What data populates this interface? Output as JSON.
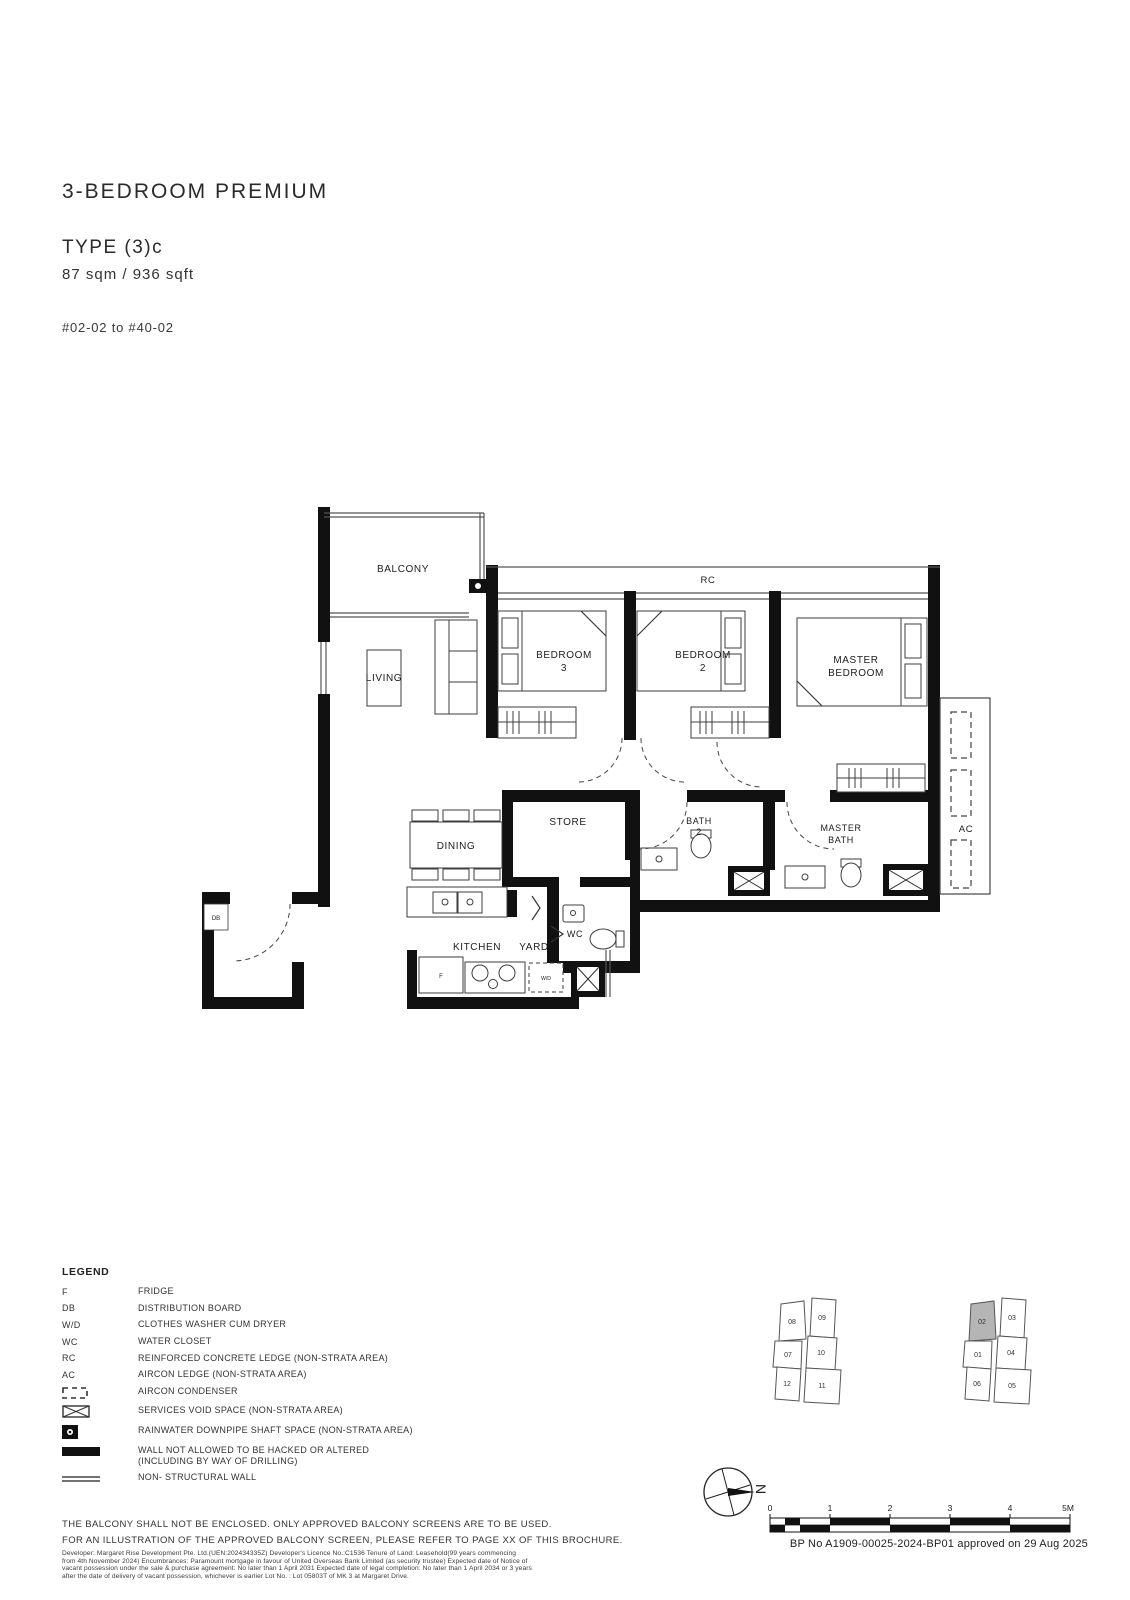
{
  "header": {
    "title": "3-BEDROOM PREMIUM",
    "type": "TYPE (3)c",
    "area": "87 sqm / 936 sqft",
    "units": "#02-02 to #40-02"
  },
  "plan": {
    "rooms": {
      "balcony": "BALCONY",
      "living": "LIVING",
      "bedroom3_1": "BEDROOM",
      "bedroom3_2": "3",
      "bedroom2_1": "BEDROOM",
      "bedroom2_2": "2",
      "master_1": "MASTER",
      "master_2": "BEDROOM",
      "rc": "RC",
      "ac": "AC",
      "dining": "DINING",
      "store": "STORE",
      "bath2_1": "BATH",
      "bath2_2": "2",
      "masterbath_1": "MASTER",
      "masterbath_2": "BATH",
      "wc": "WC",
      "kitchen": "KITCHEN",
      "yard": "YARD",
      "db": "DB",
      "fridge": "F",
      "washer": "W/D"
    }
  },
  "legend": {
    "heading": "LEGEND",
    "items": [
      {
        "symbol": "F",
        "label": "FRIDGE"
      },
      {
        "symbol": "DB",
        "label": "DISTRIBUTION BOARD"
      },
      {
        "symbol": "W/D",
        "label": "CLOTHES WASHER CUM DRYER"
      },
      {
        "symbol": "WC",
        "label": "WATER CLOSET"
      },
      {
        "symbol": "RC",
        "label": "REINFORCED CONCRETE LEDGE (NON-STRATA AREA)"
      },
      {
        "symbol": "AC",
        "label": "AIRCON LEDGE (NON-STRATA AREA)"
      },
      {
        "symbol": "",
        "label": "AIRCON CONDENSER"
      },
      {
        "symbol": "",
        "label": "SERVICES VOID SPACE (NON-STRATA AREA)"
      },
      {
        "symbol": "",
        "label": "RAINWATER DOWNPIPE SHAFT SPACE (NON-STRATA AREA)"
      },
      {
        "symbol": "",
        "label": "WALL NOT ALLOWED TO BE HACKED OR ALTERED",
        "label2": "(INCLUDING BY WAY OF DRILLING)"
      },
      {
        "symbol": "",
        "label": "NON- STRUCTURAL WALL"
      }
    ]
  },
  "notes": {
    "line1": "THE BALCONY SHALL NOT BE ENCLOSED. ONLY APPROVED BALCONY SCREENS ARE TO BE USED.",
    "line2": "FOR AN ILLUSTRATION OF THE APPROVED BALCONY SCREEN, PLEASE REFER TO PAGE XX OF THIS BROCHURE.",
    "fine_print": [
      "Developer: Margaret Rise Development Pte. Ltd.(UEN:202434335Z)  Developer's Licence No.:C1536  Tenure of Land: Leasehold(99 years commencing",
      "from 4th November 2024)  Encumbrances: Paramount mortgage in favour of United Overseas Bank Limited (as security trustee)  Expected date of Notice of",
      "vacant possession under the sale & purchase agreement: No later than 1 April 2031  Expected date of legal completion: No later than 1 April 2034 or 3 years",
      "after the date of delivery of vacant possession, whichever is earlier  Lot No. : Lot 05803T of MK 3 at Margaret Drive."
    ]
  },
  "keyplans": {
    "left": [
      "08",
      "09",
      "07",
      "10",
      "12",
      "11"
    ],
    "right": [
      "02",
      "03",
      "01",
      "04",
      "06",
      "05"
    ],
    "highlight_color": "#b5b5b5"
  },
  "compass": {
    "north": "N"
  },
  "scalebar": {
    "ticks": [
      "0",
      "1",
      "2",
      "3",
      "4"
    ],
    "end": "5M"
  },
  "approval": "BP No A1909-00025-2024-BP01 approved on 29 Aug 2025"
}
